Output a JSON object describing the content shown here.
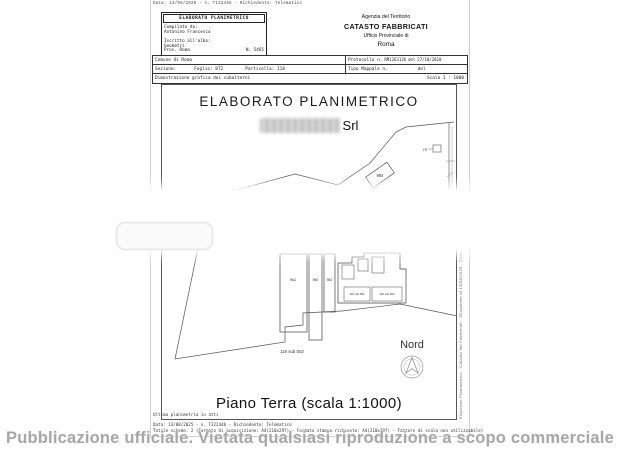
{
  "meta": {
    "top_line": "Data: 13/08/2025 - n. T122446 - Richiedente: Telematico"
  },
  "header": {
    "left_box": {
      "title": "ELABORATO PLANIMETRICO",
      "compilato_label": "Compilato da:",
      "compilato_name": "Antonino Francesco",
      "iscritto_label": "Iscritto all'albo:",
      "albo": "Geometri",
      "prov": "Prov. Roma",
      "numero": "N. 5465"
    },
    "agency_box": {
      "line1": "Agenzia del Territorio",
      "line2": "CATASTO FABBRICATI",
      "line3": "Ufficio Provinciale di",
      "line4": "Roma"
    }
  },
  "info_table": {
    "comune": "Comune di Roma",
    "protocollo_label": "Protocollo n.",
    "protocollo_value": "RM1263126",
    "protocollo_del": "del",
    "protocollo_date": "27/10/2010",
    "sezione_label": "Sezione:",
    "foglio_label": "Foglio: 872",
    "particella_label": "Particella: 118",
    "tipo_mappale_label": "Tipo Mappale n.",
    "tipo_mappale_del": "del",
    "dimostrazione": "Dimostrazione grafica dei subalterni",
    "scala": "Scala 1 : 1000"
  },
  "drawing": {
    "title": "ELABORATO PLANIMETRICO",
    "company_suffix": "Srl",
    "labels": {
      "p984": "984",
      "p79": "79",
      "p965": "965",
      "b961": "961",
      "b960": "960",
      "b962": "962",
      "sub_small_1": "118 sub 501",
      "sub_small_2": "118 sub 503",
      "sub502": "118 sub 502"
    },
    "nord": "Nord",
    "side_caption": "Elaborato Planimetrico - Catasto dei Fabbricati - Situazione al 13/08/2025 - Comune di ROMA",
    "floor_caption": "Piano Terra  (scala 1:1000)"
  },
  "footer": {
    "ultima": "Ultima planimetria in atti",
    "data_line": "Data: 13/08/2025 - n. T122446 - Richiedente: Telematico",
    "totale_line": "Totale schede: 2  (Formato di acquisizione: A4(210x297) - Formato stampa richiesto: A4(210x297) - Fattore di scala non utilizzabile)",
    "watermark": "Pubblicazione ufficiale. Vietata qualsiasi riproduzione a scopo commerciale"
  }
}
